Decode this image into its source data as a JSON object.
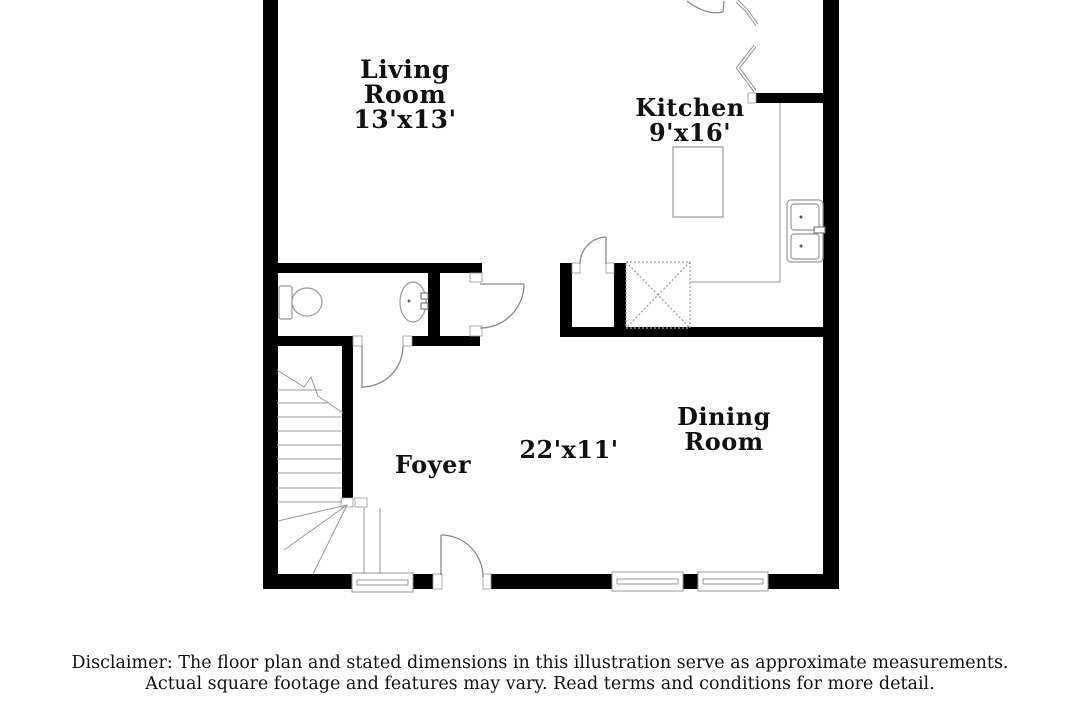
{
  "plan": {
    "rooms": {
      "living_room": {
        "label": "Living\nRoom\n13'x13'"
      },
      "kitchen": {
        "label": "Kitchen\n9'x16'"
      },
      "foyer": {
        "label": "Foyer"
      },
      "hall": {
        "label": "22'x11'"
      },
      "dining_room": {
        "label": "Dining\nRoom"
      }
    },
    "fixtures": {
      "toilet": "toilet",
      "bathroom_sink": "pedestal-sink",
      "kitchen_sink": "double-basin-sink",
      "kitchen_island": "island-counter",
      "staircase": "winder-staircase",
      "utility": "washer-dryer-area"
    },
    "colors": {
      "wall": "#000000",
      "line": "#999999",
      "text": "#111111",
      "background": "#ffffff"
    }
  },
  "disclaimer": {
    "text": "Disclaimer: The floor plan and stated dimensions in this illustration serve as approximate measurements.\nActual square footage and features may vary. Read terms and conditions for more detail."
  }
}
